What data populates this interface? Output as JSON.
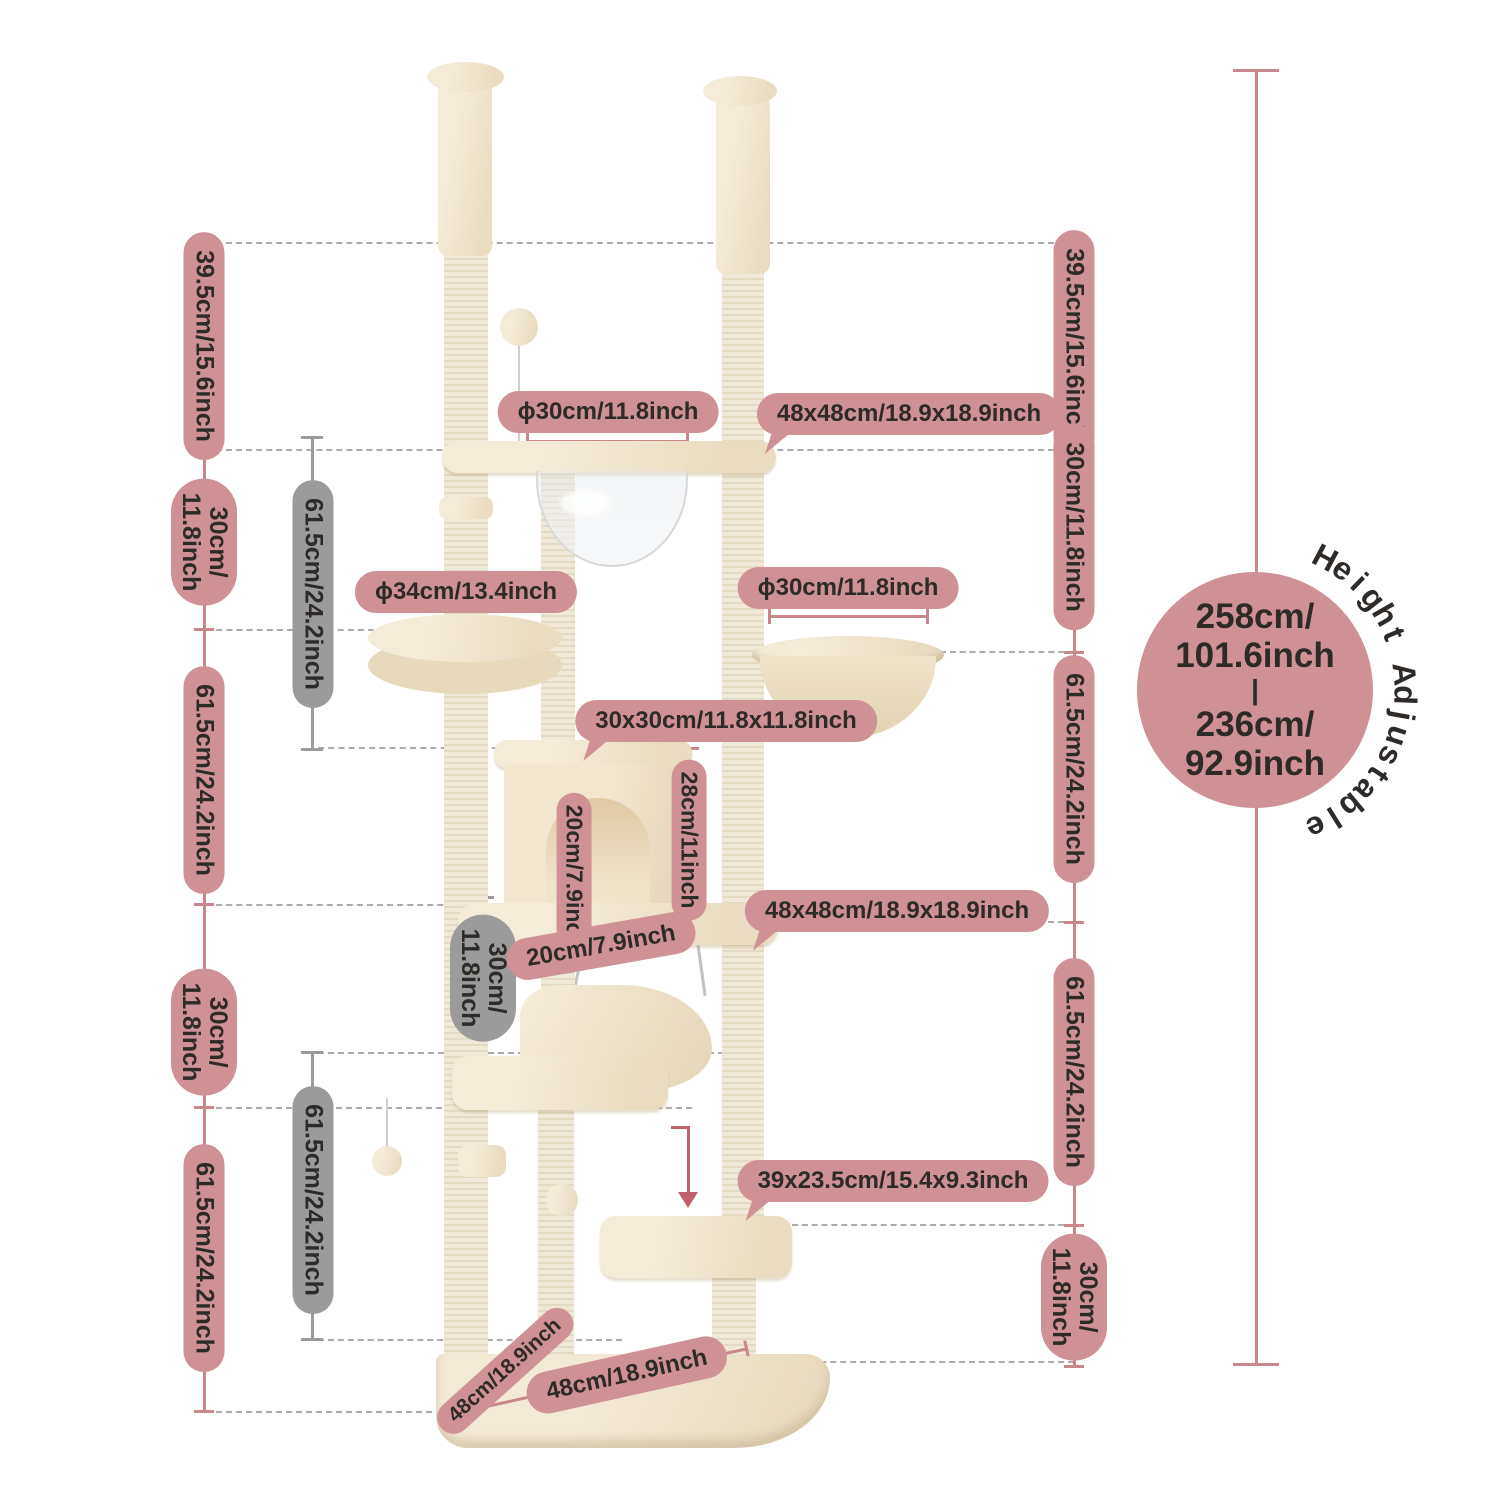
{
  "colors": {
    "accent_pink": "#cf9196",
    "accent_gray": "#9b9b9b",
    "measure_line": "#c9878d",
    "text": "#2d2a28",
    "tree_beige": "#f1e7d3",
    "arrow": "#c4606b"
  },
  "labels": {
    "left": [
      {
        "text": "39.5cm/15.6inch"
      },
      {
        "line1": "30cm/",
        "line2": "11.8inch"
      },
      {
        "text": "61.5cm/24.2inch"
      },
      {
        "line1": "30cm/",
        "line2": "11.8inch"
      },
      {
        "text": "61.5cm/24.2inch"
      }
    ],
    "inner": [
      {
        "text": "61.5cm/24.2inch"
      },
      {
        "line1": "30cm/",
        "line2": "11.8inch"
      },
      {
        "text": "61.5cm/24.2inch"
      }
    ],
    "right": [
      {
        "text": "39.5cm/15.6inch"
      },
      {
        "text": "30cm/11.8inch"
      },
      {
        "text": "61.5cm/24.2inch"
      },
      {
        "text": "61.5cm/24.2inch"
      },
      {
        "line1": "30cm/",
        "line2": "11.8inch"
      }
    ]
  },
  "callouts": {
    "top_hole": "ϕ30cm/11.8inch",
    "top_platform": "48x48cm/18.9x18.9inch",
    "basket": "ϕ30cm/11.8inch",
    "round_platform": "ϕ34cm/13.4inch",
    "condo_top": "30x30cm/11.8x11.8inch",
    "condo_height": "28cm/11inch",
    "door_height": "20cm/7.9inch",
    "mid_platform": "48x48cm/18.9x18.9inch",
    "door_width": "20cm/7.9inch",
    "step_platform": "39x23.5cm/15.4x9.3inch",
    "base_front": "48cm/18.9inch",
    "base_side": "48cm/18.9inch"
  },
  "badge": {
    "max_cm": "258cm/",
    "max_in": "101.6inch",
    "divider": "|",
    "min_cm": "236cm/",
    "min_in": "92.9inch",
    "curved_label": "Height Adjustable"
  }
}
